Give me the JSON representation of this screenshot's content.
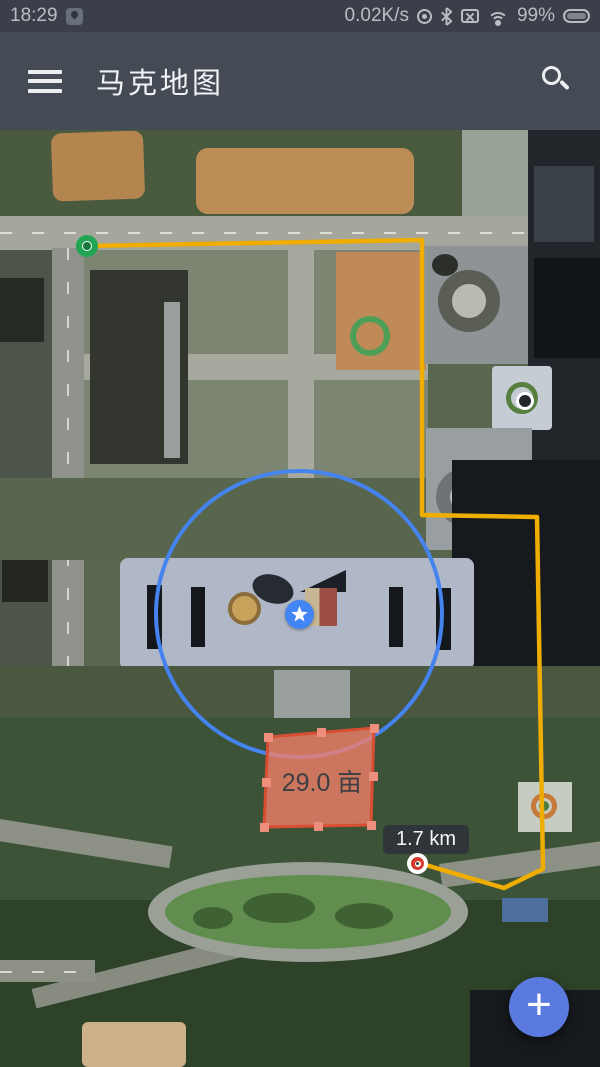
{
  "status_bar": {
    "time": "18:29",
    "net_speed": "0.02K/s",
    "battery_percent": "99%",
    "icons": [
      "app-notification-pin",
      "hotspot",
      "bluetooth",
      "no-sim",
      "wifi",
      "battery"
    ]
  },
  "app_bar": {
    "title": "马克地图",
    "icons": [
      "hamburger-menu",
      "search-magnifier"
    ]
  },
  "map": {
    "type": "satellite",
    "area_label": "29.0 亩",
    "distance_label": "1.7 km",
    "markers": [
      "route-start-green",
      "star-blue",
      "route-end-red"
    ],
    "shapes": [
      "route-polyline-yellow",
      "radius-circle-blue",
      "measure-polygon-red"
    ]
  },
  "fab": {
    "label": "+"
  },
  "colors": {
    "status_bar_bg": "#3A3F49",
    "app_bar_bg": "#454B55",
    "route_yellow": "#EFAD00",
    "radius_circle_blue": "#4583EE",
    "polygon_fill": "#F4806C",
    "polygon_stroke": "#D84E33",
    "marker_star_blue": "#4285F4",
    "marker_green": "#22A552",
    "marker_red": "#D53B2B",
    "fab_blue": "#5A7AE0",
    "label_badge_bg": "#2E3238"
  }
}
